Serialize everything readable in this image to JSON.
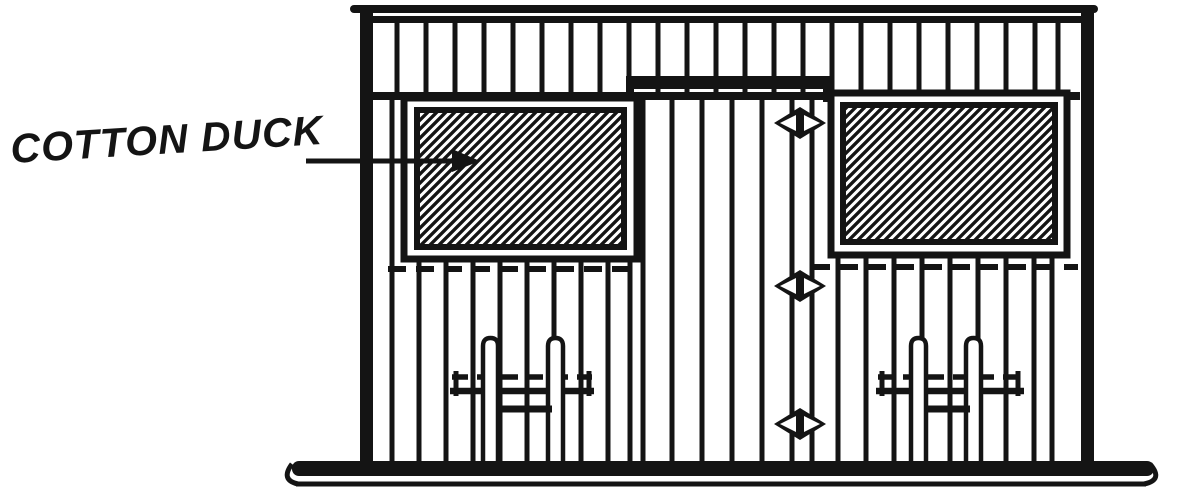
{
  "figure": {
    "kind": "line-drawing-elevation",
    "label": {
      "text": "COTTON DUCK"
    },
    "colors": {
      "ink": "#141414",
      "paper": "#ffffff"
    }
  }
}
